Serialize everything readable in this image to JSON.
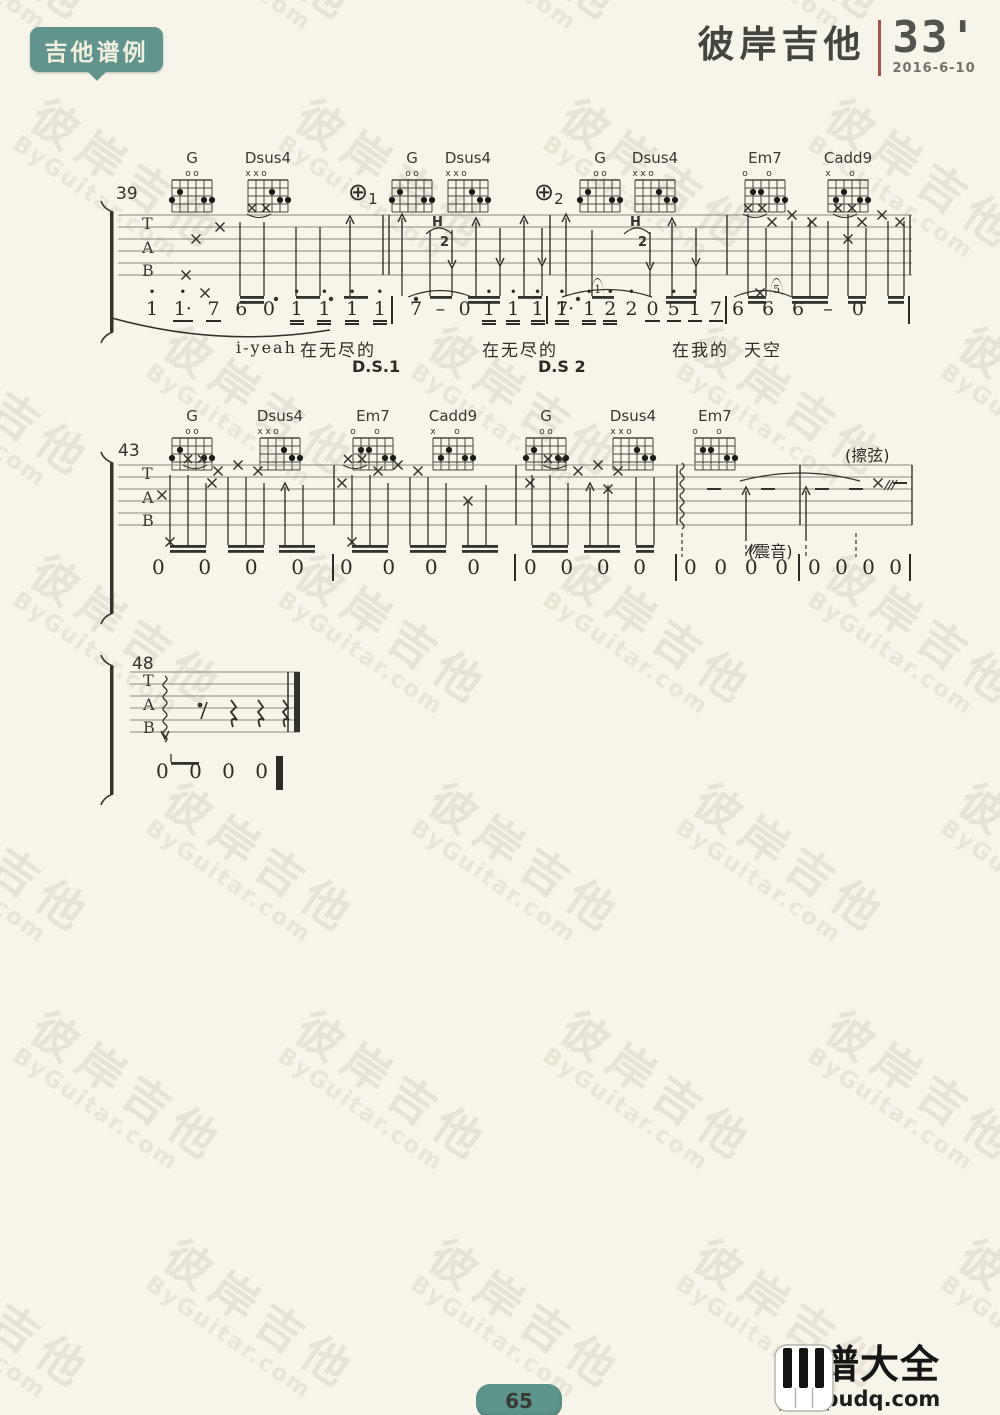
{
  "page": {
    "badge": "吉他谱例",
    "logo": {
      "brand": "彼岸吉他",
      "duration": "33'",
      "date": "2016-6-10"
    },
    "watermark": {
      "line1": "彼岸吉他",
      "line2": "ByGuitar.com"
    },
    "footer": {
      "page_number": "65",
      "site_name": "简谱大全",
      "site_url": "jianpudq.com"
    }
  },
  "staff_letters": [
    "T",
    "A",
    "B"
  ],
  "chords": {
    "shapes": {
      "G": {
        "marks": [
          "",
          "",
          "o",
          "o",
          "",
          ""
        ],
        "dots": [
          [
            1,
            3
          ],
          [
            2,
            2
          ],
          [
            5,
            3
          ],
          [
            6,
            3
          ]
        ]
      },
      "Dsus4": {
        "marks": [
          "x",
          "x",
          "o",
          "",
          "",
          ""
        ],
        "dots": [
          [
            4,
            2
          ],
          [
            5,
            3
          ],
          [
            6,
            3
          ]
        ]
      },
      "Em7": {
        "marks": [
          "o",
          "",
          "",
          "o",
          "",
          ""
        ],
        "dots": [
          [
            2,
            2
          ],
          [
            3,
            2
          ],
          [
            5,
            3
          ],
          [
            6,
            3
          ]
        ]
      },
      "Cadd9": {
        "marks": [
          "x",
          "",
          "",
          "o",
          "",
          ""
        ],
        "dots": [
          [
            2,
            3
          ],
          [
            3,
            2
          ],
          [
            5,
            3
          ],
          [
            6,
            3
          ]
        ]
      }
    }
  },
  "systems": [
    {
      "measure_number": "39",
      "chords": [
        {
          "name": "G",
          "shape": "G"
        },
        {
          "name": "Dsus4",
          "shape": "Dsus4"
        },
        {
          "name": "G",
          "shape": "G"
        },
        {
          "name": "Dsus4",
          "shape": "Dsus4"
        },
        {
          "name": "G",
          "shape": "G"
        },
        {
          "name": "Dsus4",
          "shape": "Dsus4"
        },
        {
          "name": "Em7",
          "shape": "Em7"
        },
        {
          "name": "Cadd9",
          "shape": "Cadd9"
        }
      ],
      "coda": [
        {
          "symbol": "⊕",
          "number": "1"
        },
        {
          "symbol": "⊕",
          "number": "2"
        }
      ],
      "hammer": {
        "letter": "H",
        "number": "2"
      },
      "jianpu": [
        [
          {
            "t": "1",
            "hi": 1
          },
          {
            "t": "1·",
            "hi": 1,
            "u": 1
          },
          {
            "t": "7",
            "u": 1
          },
          {
            "t": "6"
          },
          {
            "t": "0"
          },
          {
            "t": "1",
            "hi": 1,
            "u": 2
          },
          {
            "t": "1",
            "hi": 1,
            "u": 2
          },
          {
            "t": "1",
            "hi": 1,
            "u": 2
          },
          {
            "t": "1",
            "hi": 1,
            "u": 2
          }
        ],
        [
          {
            "t": "7"
          },
          {
            "t": "-"
          },
          {
            "t": "0"
          },
          {
            "t": "1",
            "hi": 1,
            "u": 2
          },
          {
            "t": "1",
            "hi": 1,
            "u": 2
          },
          {
            "t": "1",
            "hi": 1,
            "u": 2
          },
          {
            "t": "1",
            "hi": 1,
            "u": 2
          }
        ],
        [
          {
            "t": "7·"
          },
          {
            "t": "1",
            "hi": 1,
            "u": 2,
            "gr": "1"
          },
          {
            "t": "2",
            "hi": 1,
            "u": 2
          },
          {
            "t": "2",
            "hi": 1
          },
          {
            "t": "0",
            "u": 1
          },
          {
            "t": "5",
            "hi": 1,
            "u": 1
          },
          {
            "t": "1",
            "hi": 1,
            "u": 1
          },
          {
            "t": "7",
            "u": 1
          }
        ],
        [
          {
            "t": "6"
          },
          {
            "t": "6",
            "gr": "5"
          },
          {
            "t": "6"
          },
          {
            "t": "-"
          },
          {
            "t": "0"
          }
        ]
      ],
      "lyrics": [
        "i-yeah",
        "在无尽的",
        "在无尽的",
        "在我的",
        "天空"
      ],
      "ds": [
        "D.S.1",
        "D.S 2"
      ]
    },
    {
      "measure_number": "43",
      "chords": [
        {
          "name": "G",
          "shape": "G"
        },
        {
          "name": "Dsus4",
          "shape": "Dsus4"
        },
        {
          "name": "Em7",
          "shape": "Em7"
        },
        {
          "name": "Cadd9",
          "shape": "Cadd9"
        },
        {
          "name": "G",
          "shape": "G"
        },
        {
          "name": "Dsus4",
          "shape": "Dsus4"
        },
        {
          "name": "Em7",
          "shape": "Em7"
        }
      ],
      "annotations": {
        "scratch": "(擦弦)",
        "tremolo": "(震音)"
      },
      "jianpu": [
        [
          {
            "t": "0"
          },
          {
            "t": "0"
          },
          {
            "t": "0"
          },
          {
            "t": "0"
          }
        ],
        [
          {
            "t": "0"
          },
          {
            "t": "0"
          },
          {
            "t": "0"
          },
          {
            "t": "0"
          }
        ],
        [
          {
            "t": "0"
          },
          {
            "t": "0"
          },
          {
            "t": "0"
          },
          {
            "t": "0"
          }
        ],
        [
          {
            "t": "0"
          },
          {
            "t": "0"
          },
          {
            "t": "0"
          },
          {
            "t": "0"
          }
        ],
        [
          {
            "t": "0"
          },
          {
            "t": "0"
          },
          {
            "t": "0"
          },
          {
            "t": "0"
          }
        ]
      ]
    },
    {
      "measure_number": "48",
      "chords": [],
      "jianpu": [
        [
          {
            "t": "0"
          },
          {
            "t": "0"
          },
          {
            "t": "0"
          },
          {
            "t": "0"
          }
        ]
      ]
    }
  ]
}
